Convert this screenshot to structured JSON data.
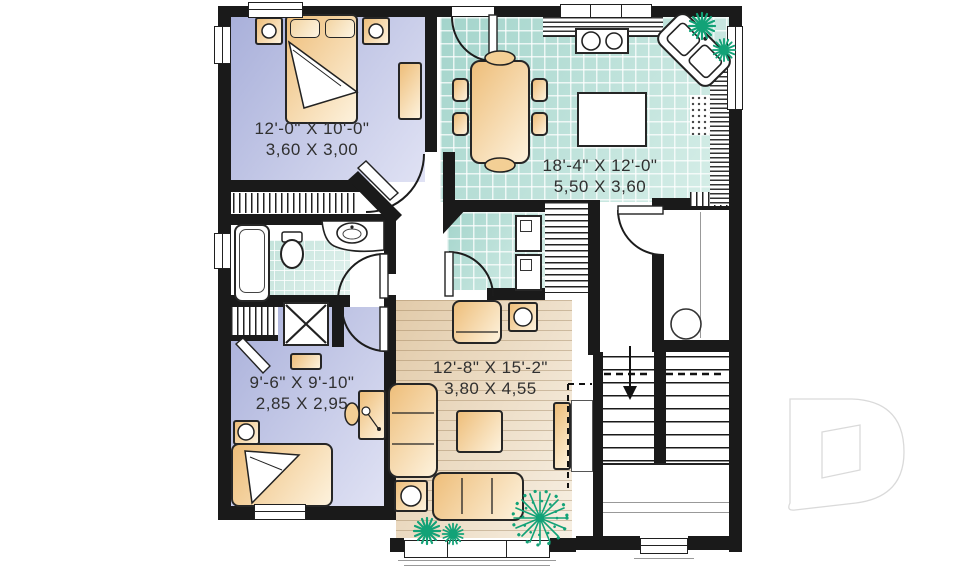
{
  "plan": {
    "rooms": {
      "bedroom_top": {
        "imperial": "12'-0\" X 10'-0\"",
        "metric": "3,60 X 3,00"
      },
      "kitchen_dining": {
        "imperial": "18'-4\" X 12'-0\"",
        "metric": "5,50 X 3,60"
      },
      "bedroom_bottom": {
        "imperial": "9'-6\" X 9'-10\"",
        "metric": "2,85 X 2,95"
      },
      "living_room": {
        "imperial": "12'-8\" X 15'-2\"",
        "metric": "3,80 X 4,55"
      }
    },
    "watermark": {
      "letter": "D"
    },
    "colors": {
      "wall": "#1a1a1a",
      "bedroom_fill": "#b9bfe2",
      "tile_fill": "#bfe3dc",
      "wood_fill": "#e9d6bc",
      "furniture_fill": "#f0c98c",
      "plant_green": "#12a277",
      "label_text": "#303030",
      "watermark_stroke": "#dadada"
    }
  }
}
